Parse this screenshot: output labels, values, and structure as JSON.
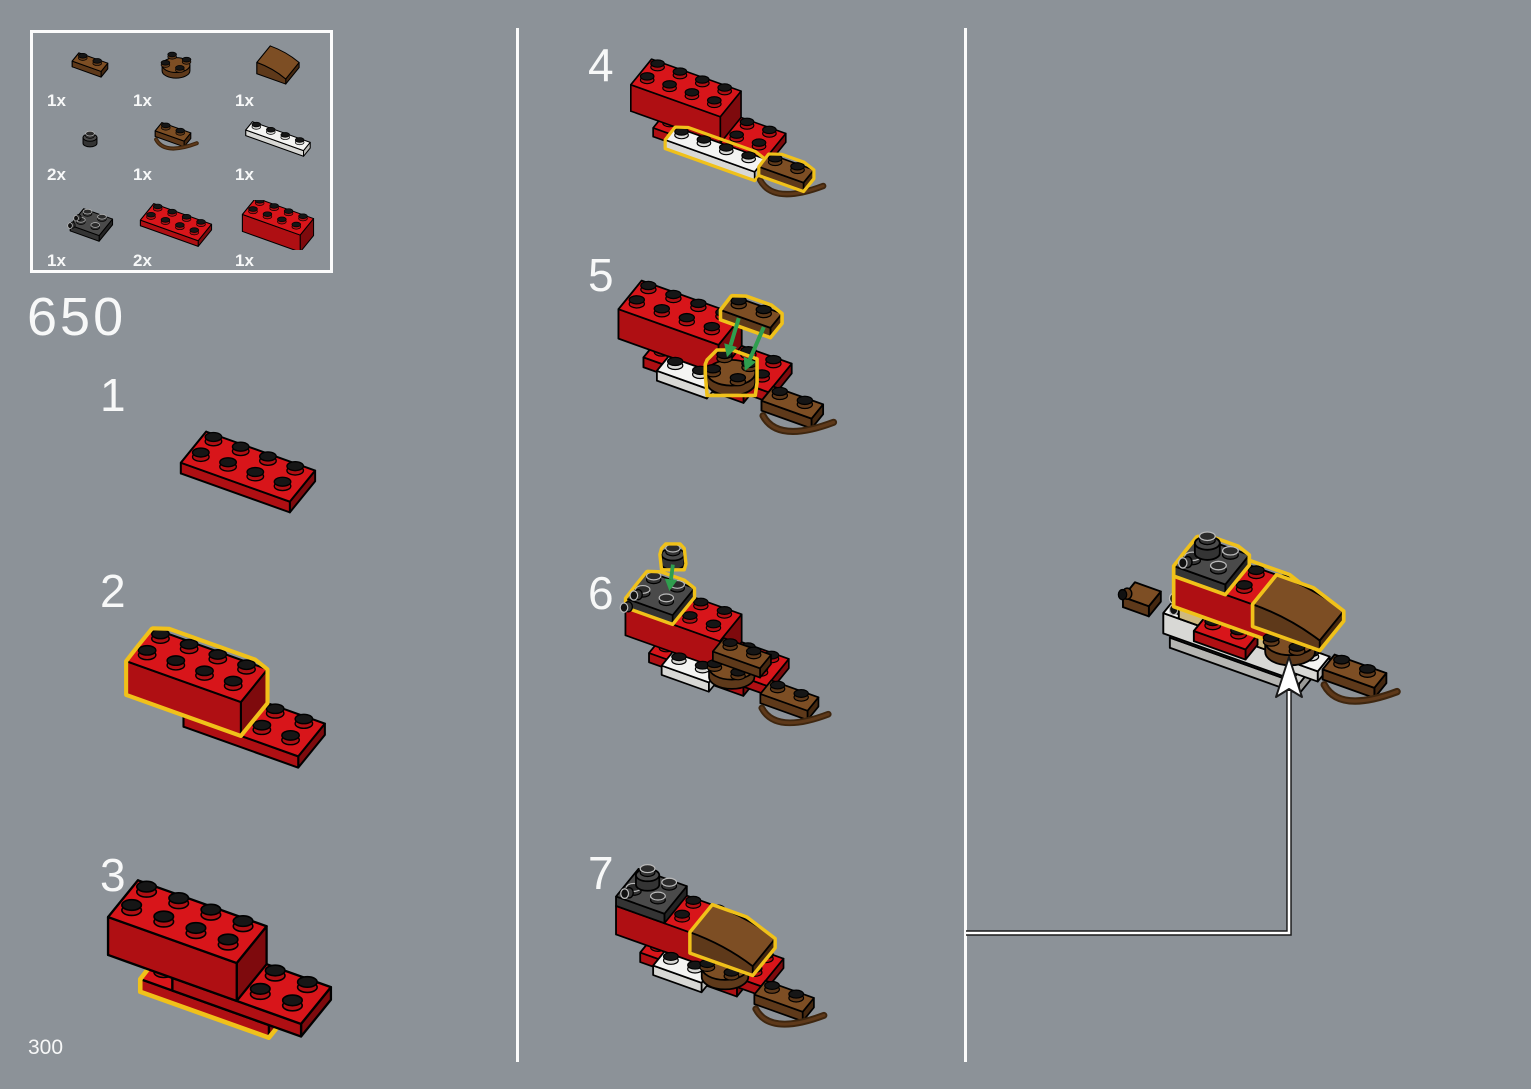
{
  "page": {
    "module_number": "650",
    "page_number": "300"
  },
  "colors": {
    "background": "#8C9298",
    "text": "#F7F8F8",
    "divider": "#FBFBFB",
    "highlight": "#F0C11A",
    "arrow_green": "#2F9E4E",
    "leader_arrow_fill": "#FFFFFF",
    "leader_arrow_outline": "#1A1A1A",
    "stud_top": "#161616",
    "palette": {
      "red": {
        "top": "#D8151A",
        "side": "#AF0F13",
        "end": "#7E0A0D"
      },
      "brown": {
        "top": "#7D4E24",
        "side": "#5E391A",
        "end": "#452810"
      },
      "white": {
        "top": "#F4F4F2",
        "side": "#D8D8D5",
        "end": "#B8B8B5"
      },
      "dark": {
        "top": "#4A4A4A",
        "side": "#343434",
        "end": "#242424"
      },
      "gray": {
        "top": "#D2D2CF",
        "side": "#B5B5B2",
        "end": "#9A9A97"
      },
      "tan": {
        "top": "#E7D4A4",
        "side": "#CEB980",
        "end": "#B19D67"
      }
    }
  },
  "icons": {
    "pointer_arrow": "up-arrow-icon",
    "placement_arrow": "green-down-arrow-icon"
  },
  "parts_panel": {
    "items": [
      {
        "qty": "1x",
        "name": "brown-1x2-rounded-plate",
        "pieces": [
          [
            "box",
            "brown",
            0,
            0,
            0,
            2,
            1,
            1,
            ""
          ]
        ]
      },
      {
        "qty": "1x",
        "name": "brown-2x2-round-plate",
        "pieces": [
          [
            "cyl",
            "brown",
            0,
            0,
            0,
            0,
            2,
            1,
            ""
          ]
        ]
      },
      {
        "qty": "1x",
        "name": "brown-curved-slope",
        "pieces": [
          [
            "slope",
            "brown",
            0,
            0,
            0,
            2,
            2,
            2,
            ""
          ]
        ]
      },
      {
        "qty": "2x",
        "name": "dark-1x1-round-plate",
        "pieces": [
          [
            "cyl",
            "dark",
            0,
            0,
            0,
            0,
            1,
            1,
            ""
          ]
        ]
      },
      {
        "qty": "1x",
        "name": "brown-1x2-plate-with-handle",
        "pieces": [
          [
            "box",
            "brown",
            0,
            0,
            0,
            2,
            1,
            1,
            "B"
          ]
        ]
      },
      {
        "qty": "1x",
        "name": "white-1x4-plate",
        "pieces": [
          [
            "box",
            "white",
            0,
            0,
            0,
            4,
            1,
            1,
            ""
          ]
        ]
      },
      {
        "qty": "1x",
        "name": "dark-2x2-bracket",
        "pieces": [
          [
            "box",
            "dark",
            0,
            0,
            0,
            2,
            2,
            1,
            ""
          ],
          [
            "cylL",
            "dark",
            0,
            0.6,
            0.3,
            0,
            0,
            0,
            ""
          ],
          [
            "cylL",
            "dark",
            0,
            1.5,
            0.3,
            0,
            0,
            0,
            ""
          ]
        ]
      },
      {
        "qty": "2x",
        "name": "red-2x4-plate",
        "pieces": [
          [
            "box",
            "red",
            0,
            0,
            0,
            4,
            2,
            1,
            ""
          ]
        ]
      },
      {
        "qty": "1x",
        "name": "red-2x4-brick",
        "pieces": [
          [
            "box",
            "red",
            0,
            0,
            0,
            4,
            2,
            3,
            ""
          ]
        ]
      }
    ]
  },
  "steps": [
    {
      "number": "1",
      "pieces": [
        [
          "box",
          "red",
          0,
          0,
          0,
          4,
          2,
          1,
          ""
        ]
      ]
    },
    {
      "number": "2",
      "pieces": [
        [
          "box",
          "red",
          2,
          0,
          0,
          4,
          2,
          1,
          ""
        ],
        [
          "box",
          "red",
          0,
          0,
          1,
          4,
          2,
          3,
          "H"
        ]
      ]
    },
    {
      "number": "3",
      "pieces": [
        [
          "box",
          "red",
          1,
          0,
          0,
          4,
          2,
          1,
          "H"
        ],
        [
          "box",
          "red",
          2,
          0,
          1,
          4,
          2,
          1,
          ""
        ],
        [
          "box",
          "red",
          0,
          0,
          2,
          4,
          2,
          3,
          ""
        ]
      ]
    },
    {
      "number": "4",
      "pieces": [
        [
          "box",
          "red",
          1,
          0,
          0,
          4,
          2,
          1,
          ""
        ],
        [
          "box",
          "red",
          2,
          0,
          1,
          4,
          2,
          1,
          "N"
        ],
        [
          "studs",
          "red",
          4,
          0,
          2,
          2,
          2,
          0,
          ""
        ],
        [
          "box",
          "red",
          0,
          0,
          2,
          4,
          2,
          3,
          ""
        ],
        [
          "box",
          "white",
          2,
          2,
          1,
          4,
          1,
          1,
          "H"
        ],
        [
          "box",
          "brown",
          6,
          1.6,
          1,
          2,
          1,
          1,
          "HB"
        ]
      ]
    },
    {
      "number": "5",
      "pieces": [
        [
          "box",
          "red",
          1,
          0,
          0,
          4,
          2,
          1,
          ""
        ],
        [
          "box",
          "red",
          2,
          0,
          1,
          4,
          2,
          1,
          "N"
        ],
        [
          "studs",
          "red",
          4,
          0,
          2,
          2,
          2,
          0,
          ""
        ],
        [
          "box",
          "red",
          0,
          0,
          2,
          4,
          2,
          3,
          ""
        ],
        [
          "box",
          "white",
          2,
          2,
          1,
          2,
          1,
          1,
          ""
        ],
        [
          "cyl",
          "brown",
          3.6,
          1.2,
          2,
          0,
          2,
          1,
          "H"
        ],
        [
          "box",
          "brown",
          6,
          1.6,
          1,
          2,
          1,
          1,
          "B"
        ],
        [
          "box",
          "brown",
          3.8,
          0.4,
          6.5,
          2,
          1,
          1,
          "H"
        ]
      ],
      "arrows": [
        {
          "from": [
            4.3,
            0.9,
            6.4
          ],
          "to": [
            4.2,
            1.7,
            3.5
          ]
        },
        {
          "from": [
            5.3,
            0.9,
            6.4
          ],
          "to": [
            5.1,
            2.1,
            3.5
          ]
        }
      ]
    },
    {
      "number": "6",
      "pieces": [
        [
          "box",
          "red",
          1,
          0,
          0,
          4,
          2,
          1,
          ""
        ],
        [
          "box",
          "red",
          2,
          0,
          1,
          4,
          2,
          1,
          "N"
        ],
        [
          "studs",
          "red",
          4,
          0,
          2,
          2,
          2,
          0,
          ""
        ],
        [
          "box",
          "red",
          0,
          0,
          2,
          4,
          2,
          3,
          ""
        ],
        [
          "box",
          "white",
          2,
          2,
          1,
          2,
          1,
          1,
          ""
        ],
        [
          "cyl",
          "brown",
          3.6,
          1.2,
          2,
          0,
          2,
          1,
          ""
        ],
        [
          "box",
          "brown",
          3.8,
          1.2,
          3,
          2,
          1,
          1,
          ""
        ],
        [
          "box",
          "brown",
          6,
          1.6,
          1,
          2,
          1,
          1,
          "B"
        ],
        [
          "box",
          "dark",
          0,
          0,
          5,
          2,
          2,
          1,
          "H"
        ],
        [
          "cylL",
          "dark",
          0,
          0.7,
          4.5,
          0,
          0,
          0,
          ""
        ],
        [
          "cylL",
          "dark",
          0,
          1.6,
          4.5,
          0,
          0,
          0,
          ""
        ],
        [
          "cyl",
          "dark",
          1,
          0.4,
          9.5,
          0,
          1,
          1,
          "H"
        ]
      ],
      "arrows": [
        {
          "from": [
            1.5,
            0.9,
            9.4
          ],
          "to": [
            1.4,
            1,
            6.6
          ]
        }
      ]
    },
    {
      "number": "7",
      "pieces": [
        [
          "box",
          "red",
          1,
          0,
          0,
          4,
          2,
          1,
          ""
        ],
        [
          "box",
          "red",
          2,
          0,
          1,
          4,
          2,
          1,
          "N"
        ],
        [
          "studs",
          "red",
          4,
          0,
          2,
          2,
          2,
          0,
          ""
        ],
        [
          "box",
          "red",
          0,
          0,
          2,
          4,
          2,
          3,
          ""
        ],
        [
          "box",
          "dark",
          0,
          0,
          5,
          2,
          2,
          1,
          ""
        ],
        [
          "cylL",
          "dark",
          0,
          0.7,
          4.5,
          0,
          0,
          0,
          ""
        ],
        [
          "cyl",
          "dark",
          0.2,
          0.2,
          6,
          0,
          1,
          1,
          ""
        ],
        [
          "box",
          "white",
          2,
          2,
          1,
          2,
          1,
          1,
          ""
        ],
        [
          "cyl",
          "brown",
          3.6,
          1.2,
          2,
          0,
          2,
          1,
          ""
        ],
        [
          "slope",
          "brown",
          3.1,
          0.1,
          3,
          2.6,
          2,
          2.2,
          "H"
        ],
        [
          "box",
          "brown",
          6,
          1.6,
          1,
          2,
          1,
          1,
          "B"
        ]
      ]
    }
  ],
  "final_assembly": {
    "pieces": [
      [
        "box",
        "gray",
        0.3,
        0.1,
        -4,
        5,
        2,
        1,
        "N"
      ],
      [
        "box",
        "white",
        0,
        0,
        -3,
        5,
        2,
        2,
        "N"
      ],
      [
        "studs",
        "white",
        0,
        0,
        -1,
        1,
        2,
        0,
        ""
      ],
      [
        "cylL",
        "dark",
        0,
        0.6,
        -1.5,
        0,
        0,
        0,
        ""
      ],
      [
        "cylL",
        "dark",
        0,
        0.6,
        -2.6,
        0,
        0,
        0,
        ""
      ],
      [
        "box",
        "brown",
        -1.7,
        0.7,
        -2.4,
        1,
        1,
        1,
        "N"
      ],
      [
        "cylL",
        "brown",
        -1.7,
        1.2,
        -1.8,
        0,
        0,
        0,
        ""
      ],
      [
        "box",
        "tan",
        0.6,
        0,
        -1,
        4,
        2,
        1,
        "N"
      ],
      [
        "box",
        "red",
        1.6,
        1.9,
        -1,
        2,
        1,
        1,
        ""
      ],
      [
        "box",
        "white",
        5.3,
        1.7,
        -1,
        1,
        1,
        1,
        ""
      ],
      [
        "box",
        "red",
        0.4,
        0,
        0,
        4,
        2,
        3,
        "H"
      ],
      [
        "box",
        "dark",
        0.4,
        0,
        3,
        2,
        2,
        1,
        "H"
      ],
      [
        "cylL",
        "dark",
        0.4,
        0.7,
        2.5,
        0,
        0,
        0,
        ""
      ],
      [
        "cyl",
        "dark",
        0.6,
        0.2,
        4,
        0,
        1,
        1,
        ""
      ],
      [
        "cyl",
        "brown",
        4,
        1.2,
        0,
        0,
        2,
        1,
        ""
      ],
      [
        "slope",
        "brown",
        3.5,
        0.1,
        1,
        2.6,
        2,
        2.2,
        "H"
      ],
      [
        "box",
        "brown",
        6.4,
        1.5,
        -1,
        2,
        1,
        1,
        "B"
      ]
    ]
  }
}
